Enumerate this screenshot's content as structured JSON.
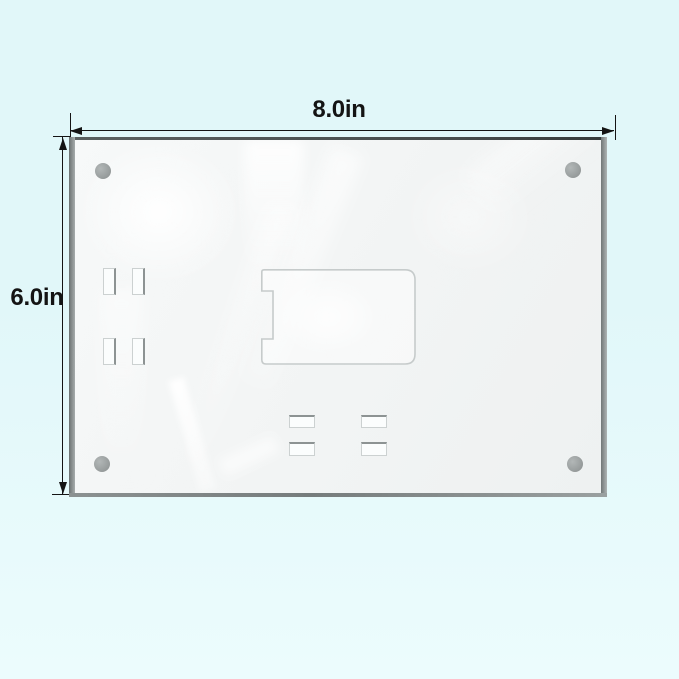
{
  "annotations": {
    "width_label": "8.0in",
    "height_label": "6.0in"
  },
  "colors": {
    "background_top": "#e1f7f9",
    "background_bottom": "#ecfcfd",
    "annotation_ink": "#141414",
    "panel_face": "#f2f4f4",
    "panel_edge": "#9aa0a0",
    "panel_edge_top": "#4d5353",
    "screw_hole": "#989d9d",
    "cutout_stroke": "#c6cbcb",
    "slot_stroke": "#ccd1d1",
    "slot_shadow": "#8d9393",
    "slot_fill": "#fbfdfd"
  }
}
